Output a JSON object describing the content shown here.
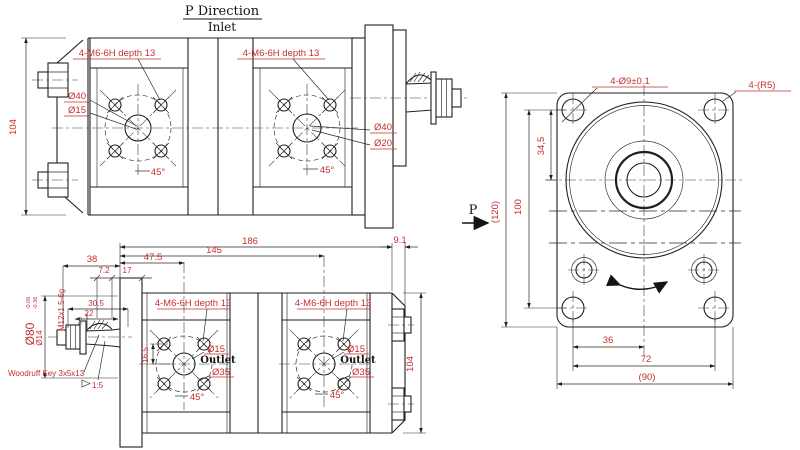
{
  "drawing": {
    "colors": {
      "dimension_text": "#c62f2f",
      "line": "#1f1f1f",
      "background": "#ffffff"
    },
    "inlet_view": {
      "title": "P Direction",
      "subtitle": "Inlet",
      "dim_height": "104",
      "thread_label": "4-M6-6H depth 13",
      "boss_dia": "Ø40",
      "port_dia": "Ø15",
      "boss_dia_right": "Ø40",
      "port_dia_right": "Ø20",
      "angle": "45°"
    },
    "outlet_view": {
      "dim_total_length": "186",
      "dim_body_length": "145",
      "dim_port_offset": "47.5",
      "dim_shaft_length": "38",
      "dim_washer": "7.2",
      "dim_flange_thk": "17",
      "dim_shaft_end": "30.5",
      "dim_taper_len": "22",
      "dim_key_height": "9.5",
      "dim_rear_cover": "9.1",
      "dim_height": "104",
      "dim_port_to_hole": "16.5",
      "thread_label": "4-M6-6H depth 13",
      "shaft_thread": "M12x1.5-6g",
      "shaft_dia": "Ø14",
      "pilot_dia": "Ø80",
      "pilot_tol_upper": "-0.06",
      "pilot_tol_lower": "-0.36",
      "key_label": "Woodruff Key 3x5x13",
      "taper": "1:5",
      "port_dia": "Ø15",
      "port_name": "Outlet",
      "boss_dia": "Ø35",
      "angle": "45°"
    },
    "flange_view": {
      "holes_label": "4-Ø9±0.1",
      "corner_label": "4-(R5)",
      "dim_hole_to_center": "34,5",
      "dim_holes_v": "100",
      "dim_height": "(120)",
      "dim_center_hole": "36",
      "dim_holes_h": "72",
      "dim_width": "(90)",
      "direction": "P"
    }
  }
}
